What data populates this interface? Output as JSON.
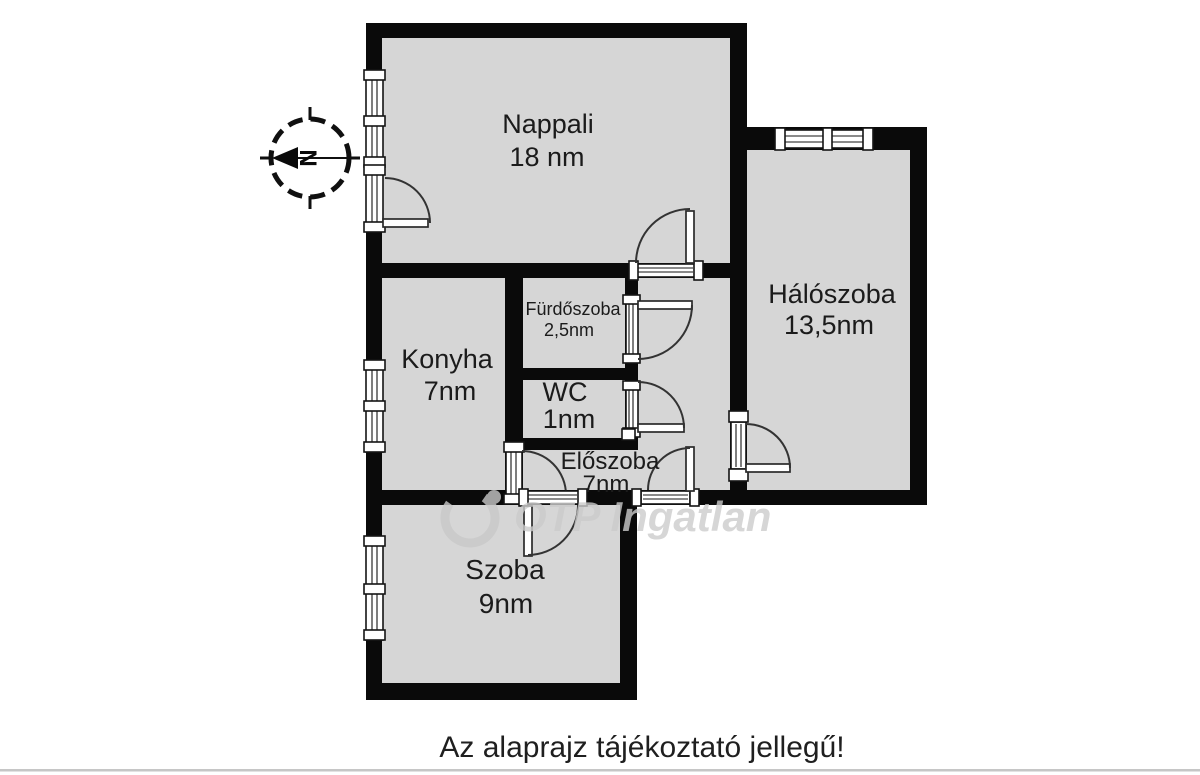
{
  "floorplan": {
    "rooms": {
      "nappali": {
        "name": "Nappali",
        "area": "18 nm"
      },
      "haloszoba": {
        "name": "Hálószoba",
        "area": "13,5nm"
      },
      "furdoszoba": {
        "name": "Fürdőszoba",
        "area": "2,5nm"
      },
      "konyha": {
        "name": "Konyha",
        "area": "7nm"
      },
      "wc": {
        "name": "WC",
        "area": "1nm"
      },
      "eloszoba": {
        "name": "Előszoba",
        "area": "7nm"
      },
      "szoba": {
        "name": "Szoba",
        "area": "9nm"
      }
    },
    "compass": {
      "north_label": "N"
    },
    "watermark": {
      "brand": "OTP Ingatlan"
    },
    "caption": "Az alaprajz tájékoztató jellegű!",
    "colors": {
      "background": "#ffffff",
      "wall": "#0a0a0a",
      "room_fill": "#d6d6d6",
      "door_line": "#333333",
      "watermark": "#cccccc",
      "text": "#1b1b1b"
    }
  }
}
